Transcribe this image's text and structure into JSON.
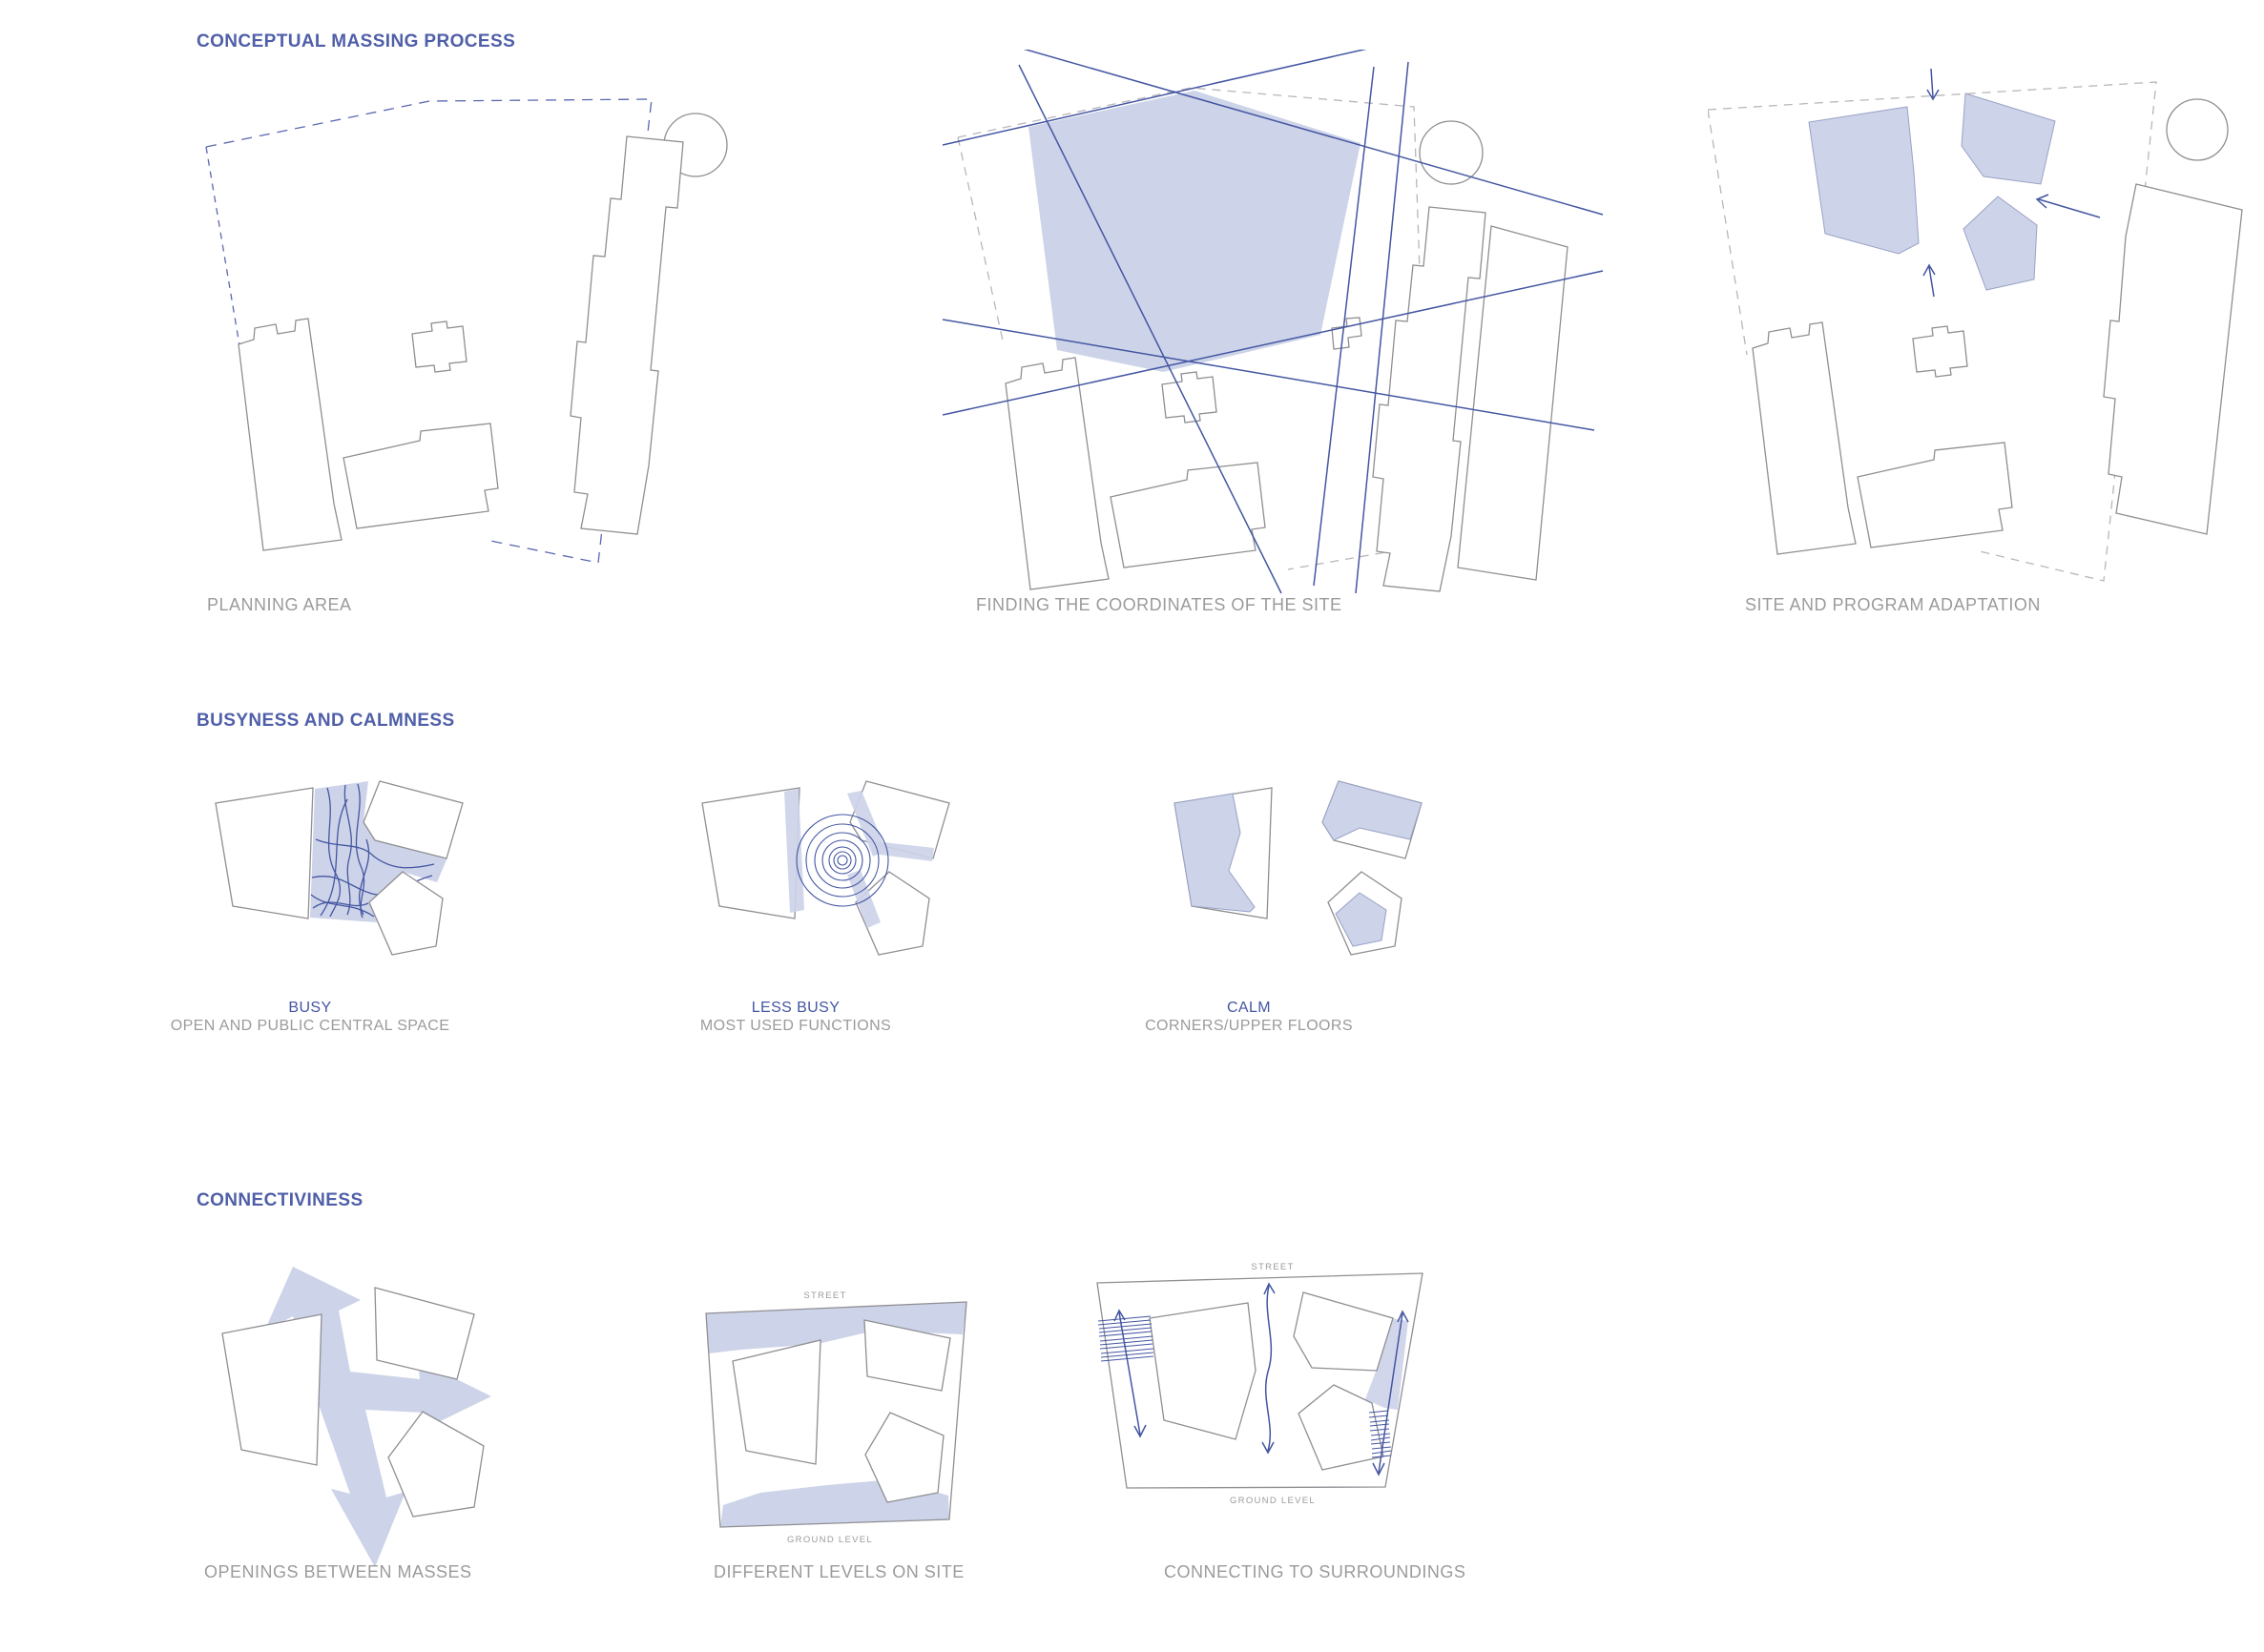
{
  "document": {
    "background": "#ffffff"
  },
  "colors": {
    "header_blue": "#4f5fa8",
    "caption_gray": "#9b9b9b",
    "label_blue": "#4456a2",
    "line_blue": "#4456a2",
    "dashed_blue": "#5a68af",
    "dashed_gray": "#b7b7bb",
    "outline_gray": "#8f8f94",
    "fill_blue": "#cdd3e8",
    "fill_edge": "#9aa2c6"
  },
  "sections": [
    {
      "title": "CONCEPTUAL MASSING PROCESS",
      "panels": [
        {
          "caption": "PLANNING AREA"
        },
        {
          "caption": "FINDING THE COORDINATES OF THE SITE"
        },
        {
          "caption": "SITE AND PROGRAM ADAPTATION"
        }
      ]
    },
    {
      "title": "BUSYNESS AND CALMNESS",
      "panels": [
        {
          "label": "BUSY",
          "caption": "OPEN AND PUBLIC CENTRAL SPACE"
        },
        {
          "label": "LESS BUSY",
          "caption": "MOST USED FUNCTIONS"
        },
        {
          "label": "CALM",
          "caption": "CORNERS/UPPER FLOORS"
        }
      ]
    },
    {
      "title": "CONNECTIVINESS",
      "panels": [
        {
          "caption": "OPENINGS BETWEEN MASSES"
        },
        {
          "caption": "DIFFERENT LEVELS ON SITE",
          "street_label": "STREET",
          "ground_label": "GROUND LEVEL"
        },
        {
          "caption": "CONNECTING TO SURROUNDINGS",
          "street_label": "STREET",
          "ground_label": "GROUND LEVEL"
        }
      ]
    }
  ]
}
